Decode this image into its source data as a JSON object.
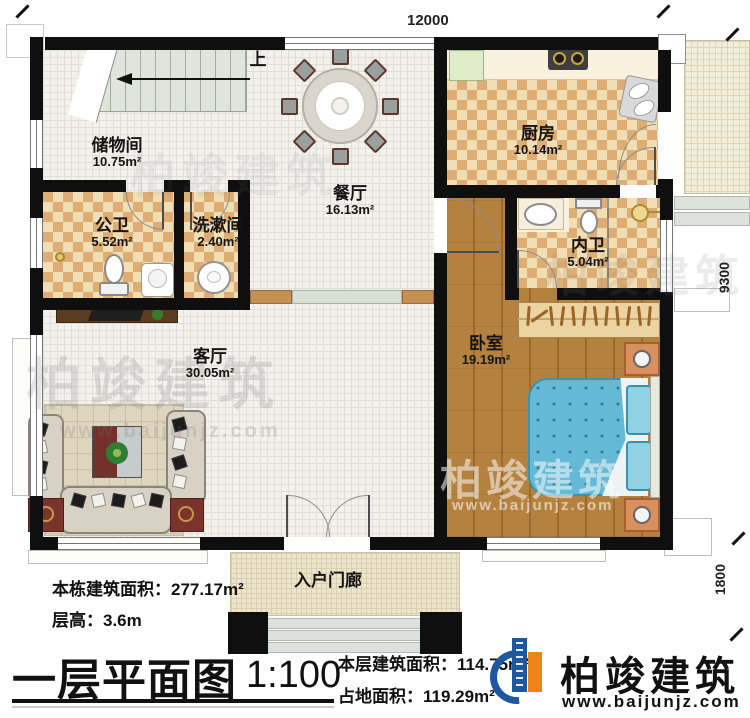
{
  "plan": {
    "dims": {
      "top": "12000",
      "right_upper": "9300",
      "right_lower": "1800"
    },
    "stairs_up": "上",
    "rooms": {
      "storage": {
        "name": "储物间",
        "area": "10.75m²"
      },
      "dining": {
        "name": "餐厅",
        "area": "16.13m²"
      },
      "kitchen": {
        "name": "厨房",
        "area": "10.14m²"
      },
      "public_bath": {
        "name": "公卫",
        "area": "5.52m²"
      },
      "washroom": {
        "name": "洗漱间",
        "area": "2.40m²"
      },
      "inner_bath": {
        "name": "内卫",
        "area": "5.04m²"
      },
      "bedroom": {
        "name": "卧室",
        "area": "19.19m²"
      },
      "living": {
        "name": "客厅",
        "area": "30.05m²"
      },
      "porch": {
        "name": "入户门廊"
      }
    }
  },
  "brand": {
    "name": "柏竣建筑",
    "site": "www.baijunjz.com"
  },
  "footer": {
    "building_area": "本栋建筑面积：277.17m²",
    "floor_height": "层高：3.6m",
    "title": "一层平面图",
    "scale": "1:100",
    "floor_area": "本层建筑面积：114.75m²",
    "footprint": "占地面积：119.29m²"
  }
}
